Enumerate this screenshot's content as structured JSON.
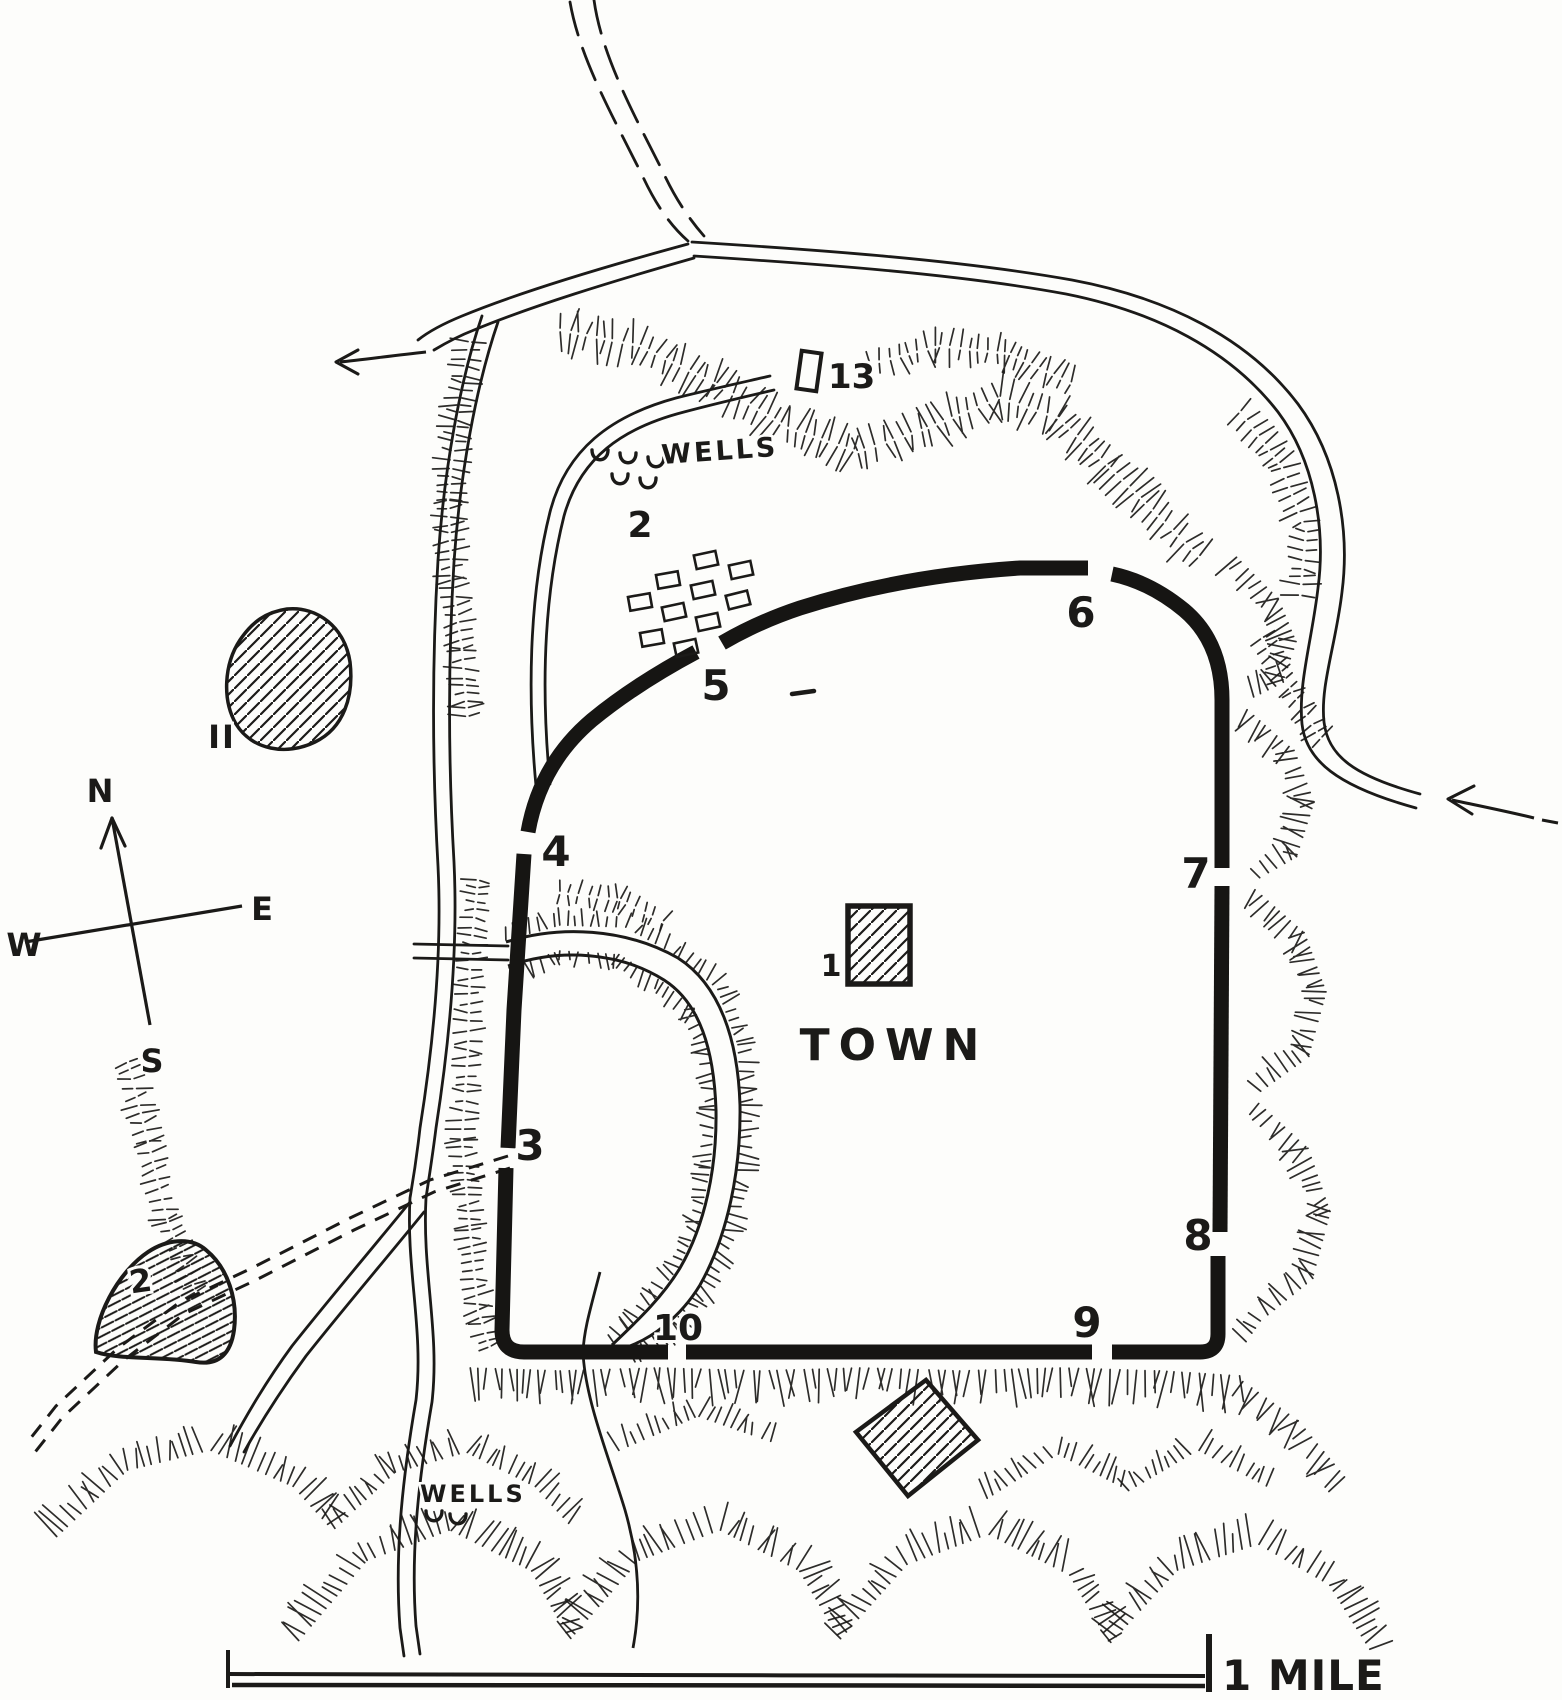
{
  "map": {
    "region_labels": {
      "town": "TOWN",
      "wells_upper": "WELLS",
      "wells_lower": "WELLS"
    },
    "numbers": {
      "citadel": "1",
      "upper_wells_area": "2",
      "mound": "2",
      "gate_3": "3",
      "gate_4": "4",
      "gate_5": "5",
      "gate_6": "6",
      "gate_7": "7",
      "gate_8": "8",
      "gate_9": "9",
      "gate_10": "10",
      "hill": "II",
      "ruin": "13"
    },
    "compass": {
      "north": "N",
      "east": "E",
      "south": "S",
      "west": "W"
    },
    "scale": {
      "label": "1 MILE"
    },
    "colors": {
      "ink": "#1b1a18",
      "paper": "#fdfdfb",
      "wall": "#161513"
    }
  }
}
